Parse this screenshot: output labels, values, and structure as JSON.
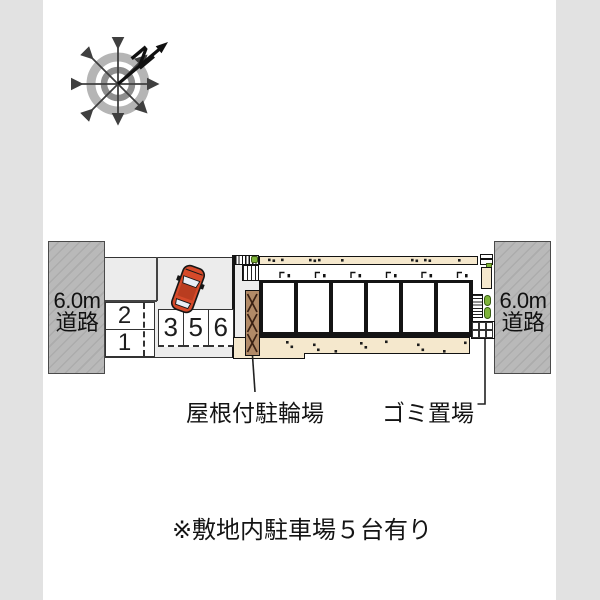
{
  "compass": {
    "north_label": "N"
  },
  "roads": {
    "left": {
      "width_label": "6.0m",
      "type_label": "道路"
    },
    "right": {
      "width_label": "6.0m",
      "type_label": "道路"
    }
  },
  "parking": {
    "spaces": {
      "s2": "2",
      "s1": "1",
      "s3": "3",
      "s5": "5",
      "s6": "6"
    }
  },
  "labels": {
    "bicycle_parking": "屋根付駐輪場",
    "garbage_area": "ゴミ置場"
  },
  "note": "※敷地内駐車場５台有り",
  "colors": {
    "road_gray": "#b8b8b8",
    "page_margin_gray": "#e2e2e2",
    "balcony_cream": "#f5e8cd",
    "bicycle_roof_brown": "#b18a67",
    "hedge_green": "#7fb43a",
    "car_red": "#d64a2a"
  }
}
